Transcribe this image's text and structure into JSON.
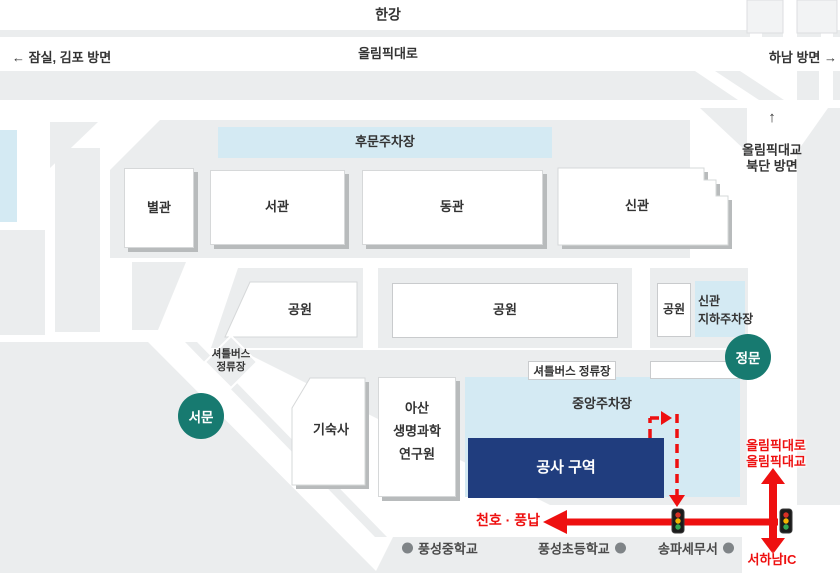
{
  "colors": {
    "teal": "#177a70",
    "navy": "#203d7e",
    "red": "#ee1010",
    "parking_blue": "#d4eaf3",
    "block_gray": "#ebedee"
  },
  "top": {
    "river": "한강",
    "highway": "올림픽대로",
    "left_direction": "← 잠실, 김포 방면",
    "right_direction": "하남 방면 →",
    "bridge_arrow": "↑",
    "bridge_line1": "올림픽대교",
    "bridge_line2": "북단 방면"
  },
  "buildings": {
    "annex": "별관",
    "west_wing": "서관",
    "east_wing": "동관",
    "new_wing": "신관",
    "dormitory": "기숙사",
    "research_line1": "아산",
    "research_line2": "생명과학",
    "research_line3": "연구원"
  },
  "parking": {
    "rear": "후문주차장",
    "central": "중앙주차장",
    "underground_line1": "신관",
    "underground_line2": "지하주차장"
  },
  "parks": [
    "공원",
    "공원",
    "공원"
  ],
  "gates": {
    "main": "정문",
    "west": "서문"
  },
  "shuttle": {
    "diamond_line1": "셔틀버스",
    "diamond_line2": "정류장",
    "box": "셔틀버스 정류장"
  },
  "construction": {
    "label": "공사 구역"
  },
  "routes": {
    "cheonho_pungnap": "천호 · 풍납",
    "olympic_line1": "올림픽대로",
    "olympic_line2": "올림픽대교",
    "seohanam_ic": "서하남IC"
  },
  "landmarks": {
    "middle_school": "풍성중학교",
    "elementary_school": "풍성초등학교",
    "tax_office": "송파세무서"
  }
}
